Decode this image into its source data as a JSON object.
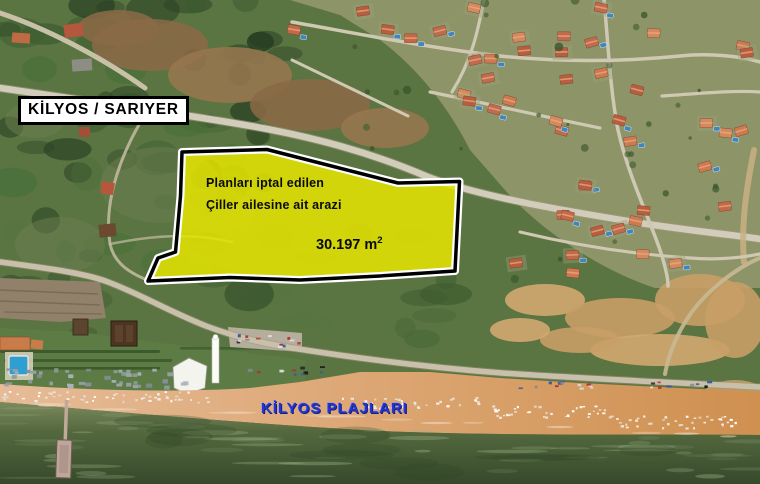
{
  "labels": {
    "region": "KİLYOS / SARIYER",
    "beach": "KİLYOS PLAJLARI"
  },
  "parcel": {
    "line1": "Planları iptal edilen",
    "line2": "Çiller ailesine ait arazi",
    "area": "30.197 m",
    "area_exponent": "2"
  },
  "colors": {
    "parcel_fill": "#e6e600",
    "parcel_border": "#000000",
    "parcel_halo": "#ffffff",
    "beach_label_blue": "#2334cf",
    "region_label_bg": "#ffffff",
    "region_label_text": "#000000"
  }
}
